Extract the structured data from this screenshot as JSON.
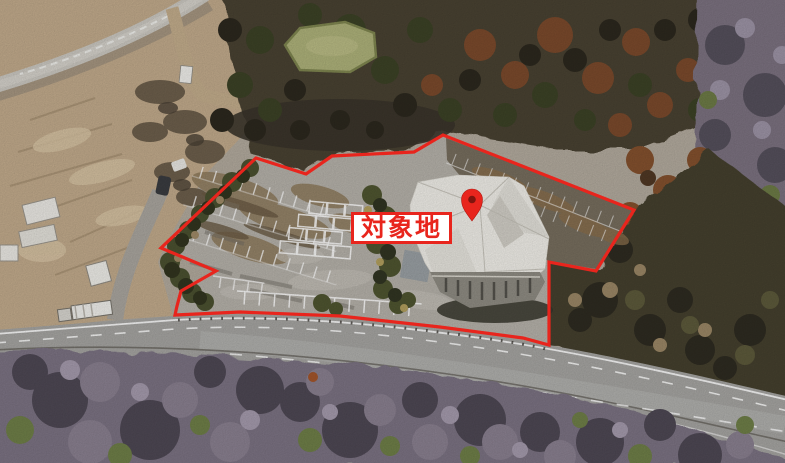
{
  "annotation": {
    "label": "対象地",
    "accent_color": "#e8251d",
    "pin_inner_color": "#7f150e",
    "boundary_points": "256,158 306,174 332,156 414,152 443,135 634,210 596,271 549,262 549,345 523,338 440,327 340,316 240,312 175,315 177,306 181,291 216,271 161,248",
    "marker_transform": "translate(472,221)"
  }
}
